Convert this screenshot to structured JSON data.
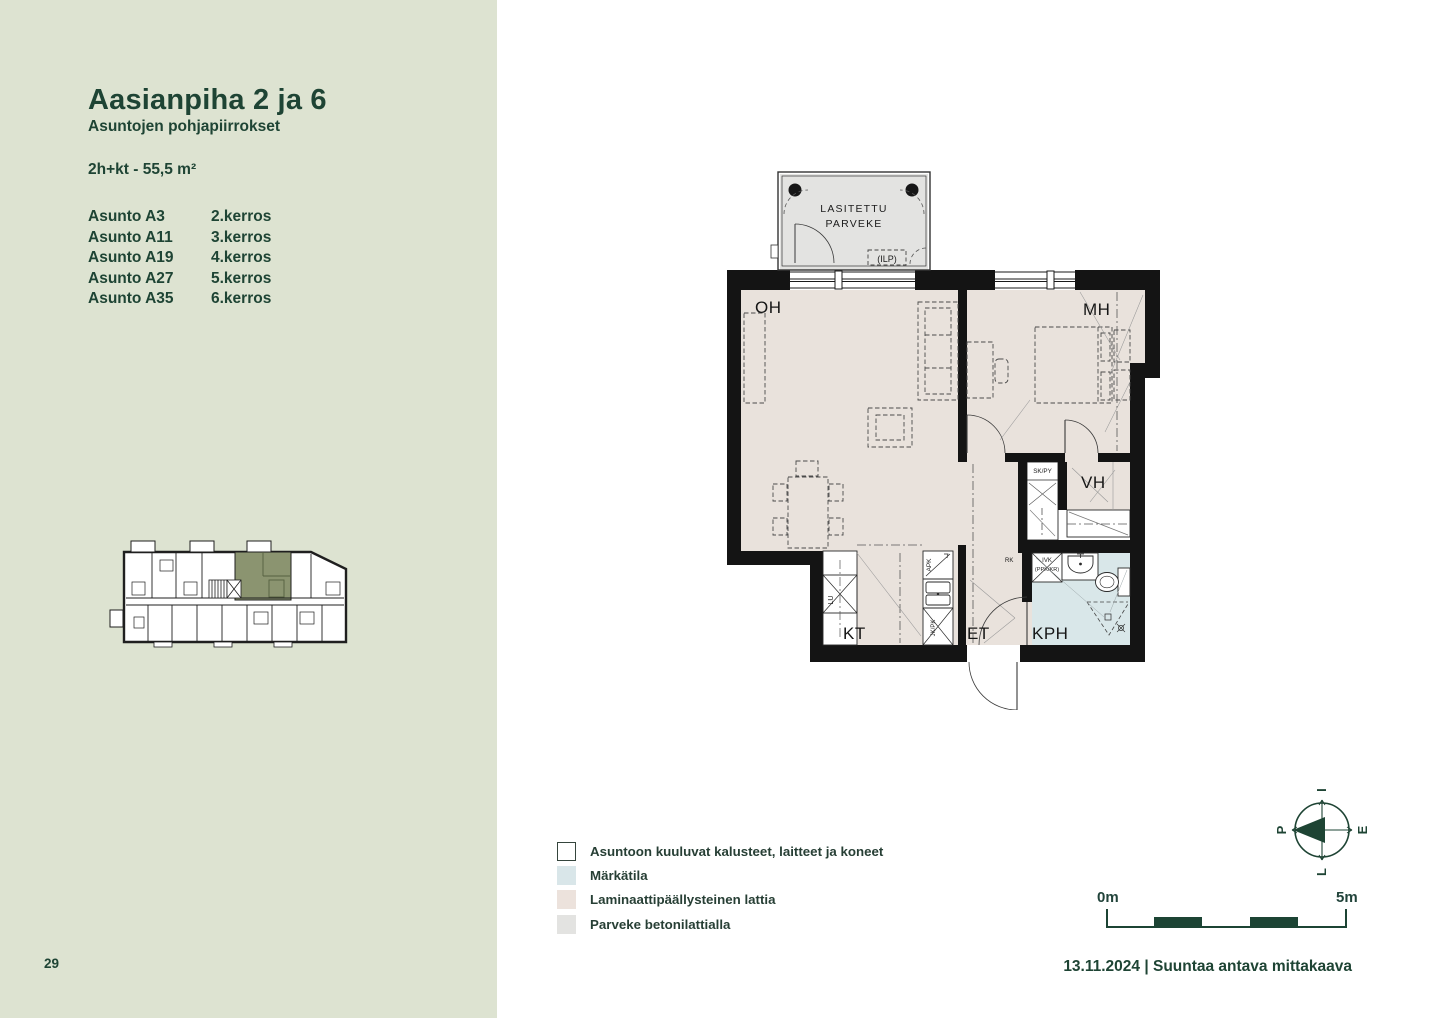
{
  "sidebar": {
    "title": "Aasianpiha 2 ja 6",
    "subtitle": "Asuntojen pohjapiirrokset",
    "apartment_type": "2h+kt - 55,5 m²",
    "units": [
      {
        "name": "Asunto A3",
        "floor": "2.kerros"
      },
      {
        "name": "Asunto A11",
        "floor": "3.kerros"
      },
      {
        "name": "Asunto A19",
        "floor": "4.kerros"
      },
      {
        "name": "Asunto A27",
        "floor": "5.kerros"
      },
      {
        "name": "Asunto A35",
        "floor": "6.kerros"
      }
    ],
    "page_number": "29"
  },
  "floorplan": {
    "labels": {
      "balcony1": "LASITETTU",
      "balcony2": "PARVEKE",
      "ilp": "(ILP)",
      "oh": "OH",
      "mh": "MH",
      "vh": "VH",
      "kt": "KT",
      "et": "ET",
      "kph": "KPH",
      "skpy": "SK/PY",
      "rk": "RK",
      "ivk": "IVK",
      "ppkkr": "(PPK/KR)",
      "apk": "APK",
      "jkpk": "JK/PK",
      "lu": "LU"
    }
  },
  "legend": {
    "items": [
      {
        "label": "Asuntoon kuuluvat kalusteet, laitteet ja koneet",
        "color": "#ffffff"
      },
      {
        "label": "Märkätila",
        "color": "#d9e6e9"
      },
      {
        "label": "Laminaattipäällysteinen lattia",
        "color": "#ece2dc"
      },
      {
        "label": "Parveke betonilattialla",
        "color": "#e3e3e1"
      }
    ]
  },
  "compass": {
    "left": "P",
    "top": "I",
    "right": "E",
    "bottom": "L"
  },
  "scalebar": {
    "start": "0m",
    "end": "5m"
  },
  "footer": {
    "date_line": "13.11.2024 | Suuntaa antava mittakaava"
  },
  "colors": {
    "accent_dark_green": "#1e4434",
    "sidebar_bg": "#dde3d1",
    "highlight_unit": "#8b9470",
    "laminate_floor": "#e9e2dc",
    "wet_room_floor": "#d9e7e9",
    "balcony_floor": "#e3e3e1",
    "scale_block": "#1c4434"
  }
}
